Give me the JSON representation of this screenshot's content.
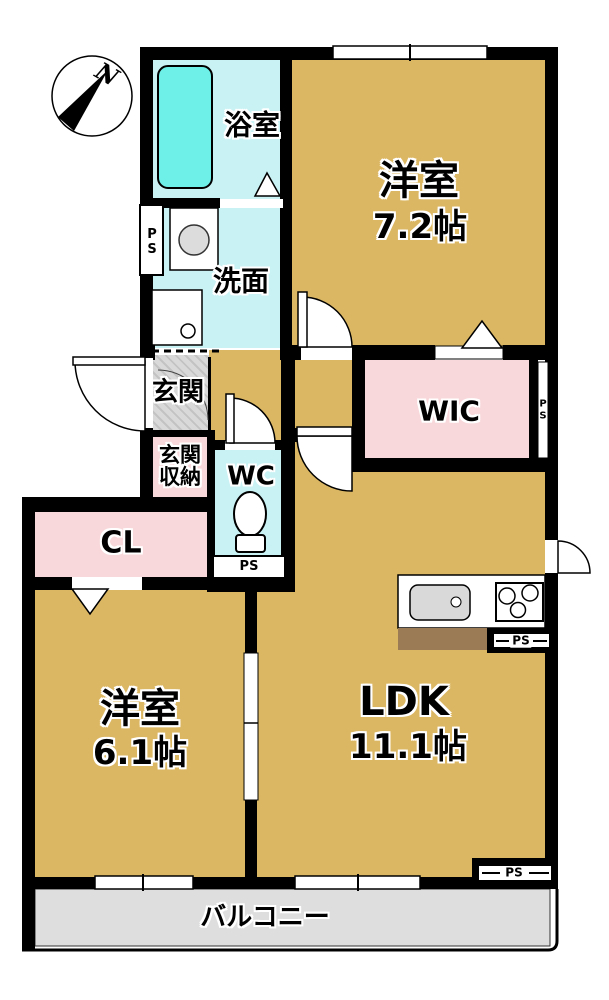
{
  "compass": {
    "north": "N"
  },
  "rooms": {
    "bath": {
      "label": "浴室"
    },
    "washroom": {
      "label": "洗面"
    },
    "western1": {
      "label": "洋室",
      "size": "7.2帖"
    },
    "entrance": {
      "label": "玄関"
    },
    "entrance_storage": {
      "label": "玄関収納"
    },
    "wc": {
      "label": "WC"
    },
    "wic": {
      "label": "WIC"
    },
    "closet": {
      "label": "CL"
    },
    "western2": {
      "label": "洋室",
      "size": "6.1帖"
    },
    "ldk": {
      "label": "LDK",
      "size": "11.1帖"
    },
    "balcony": {
      "label": "バルコニー"
    }
  },
  "pipe_spaces": {
    "washroom_ps": "PS",
    "wc_ps": "PS",
    "wic_ps": "PS",
    "kitchen_ps": "PS",
    "bottom_ps": "PS"
  },
  "colors": {
    "room_tan": "#dcb763",
    "closet_pink": "#f8d8da",
    "wet_area_cyan": "#c9f2f4",
    "bathtub_cyan": "#6ef0e8",
    "entrance_gray": "#d2d2d2",
    "balcony_gray": "#dedede",
    "counter_brown": "#9a7b55",
    "wall_black": "#000000"
  }
}
